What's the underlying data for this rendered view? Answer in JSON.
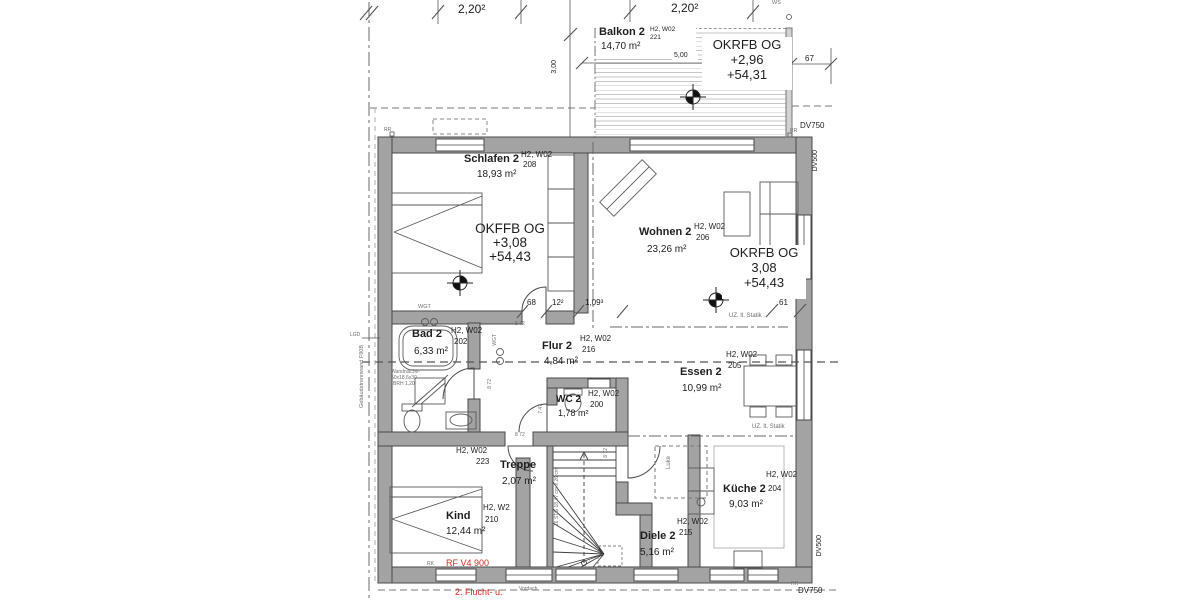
{
  "plan": {
    "rooms": {
      "balkon": {
        "name": "Balkon 2",
        "ref": "H2, W02",
        "num": "221",
        "area": "14,70 m²"
      },
      "schlafen": {
        "name": "Schlafen 2",
        "ref": "H2, W02",
        "num": "208",
        "area": "18,93 m²"
      },
      "wohnen": {
        "name": "Wohnen 2",
        "ref": "H2, W02",
        "num": "206",
        "area": "23,26 m²"
      },
      "bad": {
        "name": "Bad 2",
        "ref": "H2, W02",
        "num": "202",
        "area": "6,33 m²"
      },
      "flur": {
        "name": "Flur 2",
        "ref": "H2, W02",
        "num": "216",
        "area": "4,84 m²"
      },
      "essen": {
        "name": "Essen 2",
        "ref": "H2, W02",
        "num": "205",
        "area": "10,99 m²"
      },
      "wc": {
        "name": "WC 2",
        "ref": "H2, W02",
        "num": "200",
        "area": "1,78 m²"
      },
      "treppe": {
        "name": "Treppe",
        "ref": "H2, W02",
        "num": "223",
        "area": "2,07 m²"
      },
      "kind": {
        "name": "Kind",
        "ref": "H2, W2",
        "num": "210",
        "area": "12,44 m²"
      },
      "diele": {
        "name": "Diele 2",
        "ref": "H2, W02",
        "num": "215",
        "area": "5,16 m²"
      },
      "kueche": {
        "name": "Küche 2",
        "ref": "H2, W02",
        "num": "204",
        "area": "9,03 m²"
      }
    },
    "levels": {
      "balkon": {
        "l1": "OKRFB OG",
        "l2": "+2,96",
        "l3": "+54,31"
      },
      "schlafen": {
        "l1": "OKFFB OG",
        "l2": "+3,08",
        "l3": "+54,43"
      },
      "wohnen": {
        "l1": "OKRFB OG",
        "l2": "3,08",
        "l3": "+54,43"
      }
    },
    "dims": {
      "a": "2,20²",
      "b": "2,20²",
      "w500": "5,00",
      "h300": "3,00",
      "d67": "67",
      "d68": "68",
      "d12": "12²",
      "d109": "1,09³",
      "d61": "61",
      "d872": "8 72",
      "d747": "7 47"
    },
    "notes": {
      "uz": "UZ. lt. Statik",
      "wandnische1": "Wandnische-",
      "wandnische2": "50x18,6x30",
      "wandnische3": "BRH 1,20",
      "trennwand": "Gebäudetrennwand F90B",
      "wgt": "WGT",
      "lgd": "LGD",
      "luke": "Luke",
      "stair": "16 STG 18,47 cm x 26 cm",
      "rf": "RF V4 900",
      "flucht": "2. Flucht- u.",
      "vordach": "Vordach",
      "rk": "RK",
      "rr": "RR",
      "ws": "WS",
      "dv750": "DV750",
      "dv500": "DV500"
    },
    "colors": {
      "wall": "#a3a3a3",
      "line": "#444444",
      "red": "#d42a20",
      "hatch": "#c6c6c6"
    }
  }
}
